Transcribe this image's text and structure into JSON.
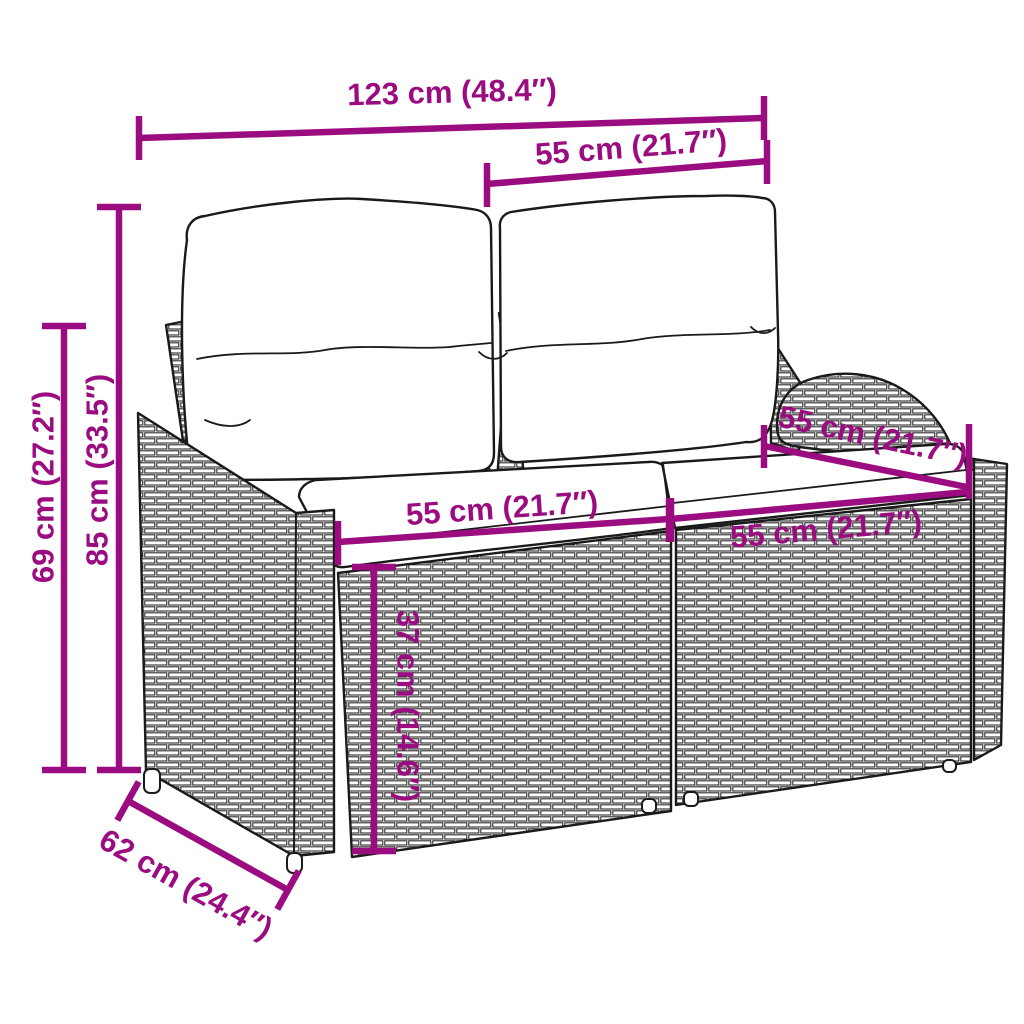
{
  "colors": {
    "accent": "#9a0c7f",
    "outline": "#1a1a1a",
    "background": "#ffffff"
  },
  "illustration": {
    "name": "rattan-two-seater-garden-sofa-with-back-and-seat-cushions",
    "style": "black-line-art-with-woven-texture"
  },
  "annotations": {
    "total_width": "123 cm (48.4″)",
    "back_cushion_width": "55 cm (21.7″)",
    "back_height": "85 cm (33.5″)",
    "arm_height": "69 cm (27.2″)",
    "seat_width_left": "55 cm (21.7″)",
    "seat_depth": "55 cm (21.7″)",
    "seat_width_right": "55 cm (21.7″)",
    "seat_height": "37 cm (14.6″)",
    "total_depth": "62 cm (24.4″)"
  }
}
